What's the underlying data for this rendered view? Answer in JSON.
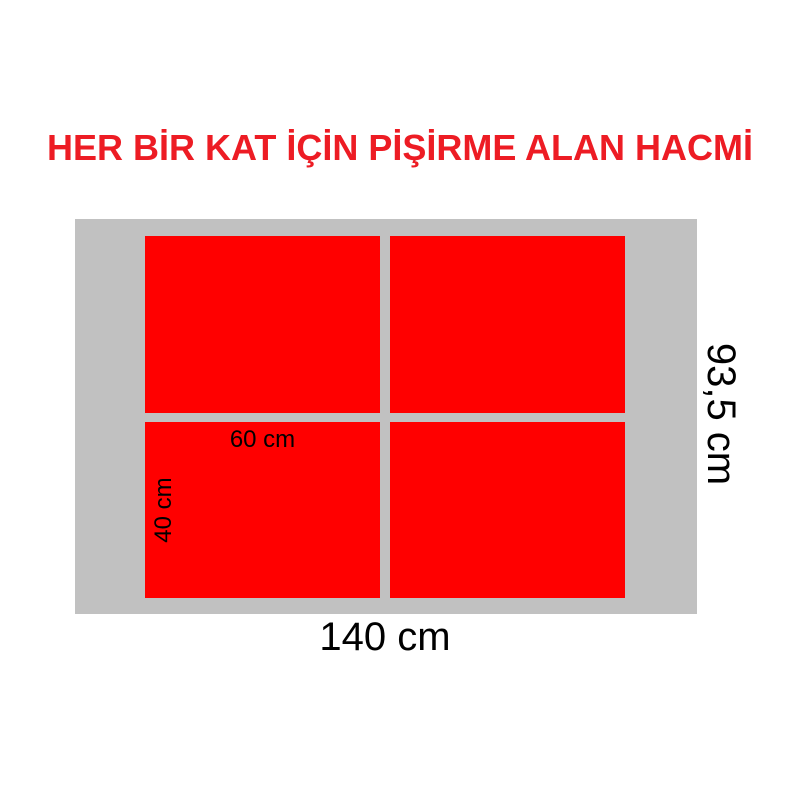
{
  "title": {
    "text": "HER BİR KAT İÇİN PİŞİRME ALAN HACMİ",
    "color": "#ED1C24"
  },
  "diagram": {
    "deck_color": "#C1C1C1",
    "cooking_area_color": "#FF0000",
    "cooking_areas_count": 4,
    "dimensions": {
      "tray_width": "60 cm",
      "tray_height": "40 cm",
      "deck_width": "140 cm",
      "deck_height": "93,5 cm"
    }
  }
}
